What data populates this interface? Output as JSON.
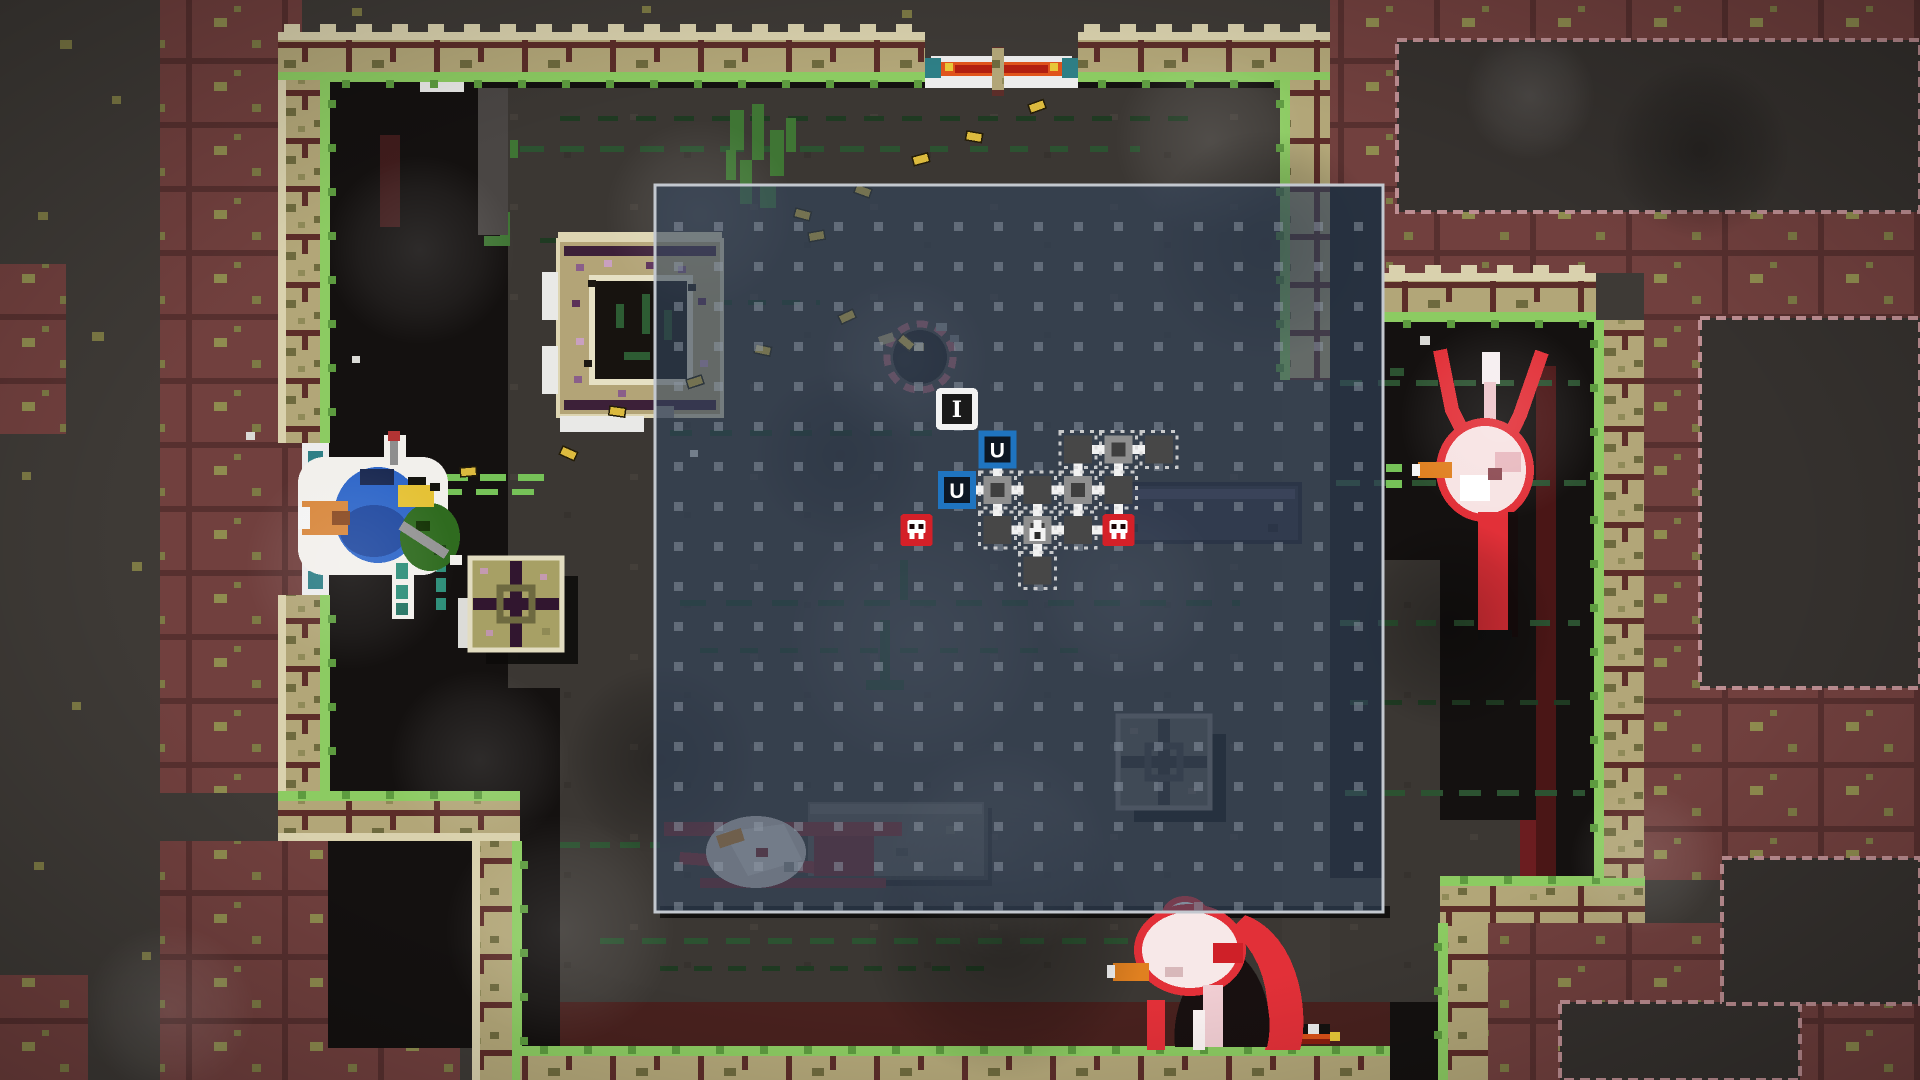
{
  "scene": {
    "description": "top-down pixel dungeon room with tactical map overlay",
    "width": 1920,
    "height": 1080
  },
  "letters": {
    "item_node": "I",
    "unknown_node": "U"
  },
  "colors": {
    "outer_grey": "#3e3a36",
    "maroon": "#71403e",
    "patch_fill": "#35312e",
    "patch_outline": "#bd8e92",
    "khaki": "#b2a678",
    "mortar": "#5c2d29",
    "cream": "#d9d1ad",
    "grass": "#8ccb62",
    "grass_dark": "#5d9b3f",
    "floor_black": "#141110",
    "floor_grey": "#3b3733",
    "overlay_fill": "#33455e",
    "overlay_border": "#c3c8cf",
    "grid_dot": "#8f99a6",
    "casing": "#dcba3e",
    "olive_speckle": "#7d7a45",
    "green_bright": "#76c258",
    "green_dark": "#2c5231",
    "green_darker": "#1f3a22",
    "teal": "#2e8f7a",
    "vine": "#3f7534",
    "node_dark": "#474747",
    "node_lit": "#8f8f8f",
    "node_inner": "#3f3f3f",
    "node_dotted": "#d9d9d9",
    "skull_red": "#d42028",
    "unknown_blue": "#1f74c0",
    "item_white": "#f2f2f2",
    "connector_white": "#f2f2f2"
  },
  "map": {
    "maroon_areas": [
      [
        160,
        0,
        142,
        793
      ],
      [
        0,
        264,
        66,
        170
      ],
      [
        1330,
        0,
        590,
        187
      ],
      [
        1383,
        187,
        537,
        86
      ],
      [
        1644,
        273,
        276,
        607
      ],
      [
        1482,
        923,
        438,
        157
      ],
      [
        160,
        841,
        300,
        239
      ],
      [
        0,
        975,
        88,
        105
      ]
    ],
    "pink_patches": [
      [
        1397,
        40,
        523,
        172
      ],
      [
        1700,
        318,
        220,
        370
      ],
      [
        1560,
        1002,
        240,
        78
      ],
      [
        1722,
        858,
        198,
        146
      ]
    ],
    "floors_black": [
      [
        328,
        80,
        954,
        968
      ],
      [
        1330,
        187,
        53,
        691
      ],
      [
        1383,
        320,
        213,
        558
      ],
      [
        1540,
        820,
        57,
        58
      ],
      [
        1390,
        1002,
        50,
        78
      ]
    ],
    "floors_grey": [
      [
        508,
        88,
        774,
        600
      ],
      [
        560,
        688,
        722,
        314
      ],
      [
        1383,
        560,
        57,
        442
      ],
      [
        1330,
        878,
        110,
        124
      ],
      [
        1430,
        820,
        90,
        58
      ]
    ],
    "red_bands": [
      [
        560,
        1002,
        830,
        46,
        "#48211e"
      ],
      [
        1520,
        820,
        20,
        58,
        "#6b1d20"
      ],
      [
        1536,
        366,
        20,
        512,
        "#4a1616"
      ],
      [
        380,
        135,
        20,
        92,
        "#3f1c1c"
      ]
    ],
    "dark_lines": [
      [
        660,
        906,
        730,
        12
      ]
    ],
    "walls": [
      {
        "x": 278,
        "y": 32,
        "w": 647,
        "h": 48,
        "cream": "top",
        "green": "bottom"
      },
      {
        "x": 1078,
        "y": 32,
        "w": 252,
        "h": 48,
        "cream": "top",
        "green": "bottom"
      },
      {
        "x": 278,
        "y": 80,
        "w": 50,
        "h": 363,
        "cream": "left",
        "green": "right"
      },
      {
        "x": 278,
        "y": 595,
        "w": 50,
        "h": 198,
        "cream": "left",
        "green": "right"
      },
      {
        "x": 278,
        "y": 793,
        "w": 242,
        "h": 48,
        "cream": "bottom",
        "green": "top"
      },
      {
        "x": 472,
        "y": 841,
        "w": 48,
        "h": 239,
        "cream": "left",
        "green": "right"
      },
      {
        "x": 520,
        "y": 1048,
        "w": 870,
        "h": 32,
        "green": "top"
      },
      {
        "x": 1440,
        "y": 923,
        "w": 48,
        "h": 157,
        "green": "left"
      },
      {
        "x": 1440,
        "y": 878,
        "w": 205,
        "h": 45,
        "green": "top"
      },
      {
        "x": 1596,
        "y": 320,
        "w": 48,
        "h": 558,
        "green": "left"
      },
      {
        "x": 1383,
        "y": 273,
        "w": 213,
        "h": 47,
        "cream": "top",
        "green": "bottom"
      },
      {
        "x": 1282,
        "y": 80,
        "w": 48,
        "h": 300,
        "green": "left"
      }
    ],
    "wall_pillar": [
      992,
      47,
      12,
      49
    ],
    "green_lines": [
      [
        404,
        474,
        142,
        7,
        "b",
        "26 12"
      ],
      [
        404,
        489,
        142,
        6,
        "b",
        "22 14"
      ],
      [
        520,
        146,
        380,
        6,
        "d",
        "24 16"
      ],
      [
        930,
        146,
        210,
        6,
        "d",
        "18 22"
      ],
      [
        560,
        116,
        640,
        5,
        "dd",
        "20 18"
      ],
      [
        540,
        238,
        180,
        5,
        "dd",
        "16 14"
      ],
      [
        680,
        300,
        140,
        5,
        "dd",
        "18 16"
      ],
      [
        670,
        430,
        270,
        6,
        "dd",
        "22 18"
      ],
      [
        680,
        600,
        560,
        6,
        "dd",
        "26 20"
      ],
      [
        700,
        648,
        400,
        5,
        "dd",
        "18 22"
      ],
      [
        600,
        938,
        660,
        6,
        "d",
        "24 18"
      ],
      [
        660,
        966,
        340,
        5,
        "dd",
        "18 16"
      ],
      [
        560,
        842,
        100,
        6,
        "d",
        "20 10"
      ],
      [
        1340,
        380,
        240,
        6,
        "d",
        "22 16"
      ],
      [
        1336,
        480,
        250,
        6,
        "d",
        "24 14"
      ],
      [
        1340,
        620,
        240,
        6,
        "d",
        "20 18"
      ],
      [
        1350,
        700,
        220,
        5,
        "dd",
        "18 16"
      ],
      [
        1345,
        790,
        240,
        6,
        "d",
        "22 16"
      ],
      [
        1386,
        464,
        16,
        8,
        "b",
        ""
      ],
      [
        1386,
        480,
        16,
        8,
        "b",
        ""
      ]
    ],
    "green_pixels": [
      [
        436,
        556,
        10,
        16,
        "t"
      ],
      [
        436,
        578,
        10,
        14,
        "t"
      ],
      [
        436,
        598,
        10,
        12,
        "t"
      ],
      [
        484,
        150,
        10,
        24,
        "v"
      ],
      [
        492,
        178,
        12,
        30,
        "v"
      ],
      [
        500,
        212,
        10,
        26,
        "v"
      ],
      [
        510,
        140,
        8,
        18,
        "v"
      ],
      [
        484,
        236,
        26,
        10,
        "v"
      ],
      [
        730,
        110,
        14,
        40,
        "v"
      ],
      [
        752,
        104,
        12,
        56,
        "v"
      ],
      [
        770,
        130,
        14,
        46,
        "v"
      ],
      [
        740,
        160,
        12,
        44,
        "v"
      ],
      [
        760,
        186,
        16,
        22,
        "v"
      ],
      [
        726,
        150,
        10,
        30,
        "v"
      ],
      [
        786,
        118,
        10,
        34,
        "v"
      ],
      [
        1390,
        368,
        14,
        8,
        "d"
      ],
      [
        880,
        620,
        10,
        60,
        "dd"
      ],
      [
        866,
        680,
        38,
        10,
        "dd"
      ],
      [
        900,
        560,
        8,
        40,
        "dd"
      ]
    ],
    "olive_speckles": [
      [
        60,
        40,
        12,
        9
      ],
      [
        112,
        96,
        9,
        8
      ],
      [
        38,
        212,
        10,
        8
      ],
      [
        92,
        332,
        12,
        9
      ],
      [
        22,
        472,
        9,
        8
      ],
      [
        132,
        562,
        10,
        9
      ],
      [
        72,
        702,
        9,
        8
      ],
      [
        34,
        862,
        10,
        8
      ],
      [
        142,
        952,
        9,
        8
      ],
      [
        184,
        1022,
        10,
        8
      ],
      [
        352,
        8,
        10,
        8
      ],
      [
        642,
        6,
        9,
        7
      ],
      [
        902,
        10,
        10,
        8
      ],
      [
        1352,
        14,
        9,
        8
      ],
      [
        1662,
        122,
        12,
        9
      ],
      [
        1852,
        62,
        10,
        8
      ],
      [
        1792,
        242,
        9,
        8
      ],
      [
        1882,
        332,
        10,
        9
      ],
      [
        1702,
        562,
        10,
        8
      ],
      [
        1862,
        642,
        9,
        8
      ],
      [
        1742,
        762,
        10,
        9
      ],
      [
        1892,
        822,
        9,
        8
      ],
      [
        240,
        1062,
        10,
        8
      ],
      [
        520,
        1066,
        9,
        7
      ]
    ],
    "hang_strip": {
      "strip": [
        478,
        88,
        30,
        147
      ],
      "white_bar": [
        420,
        80,
        44,
        12
      ]
    }
  },
  "doors": [
    {
      "name": "doorway-top",
      "sprite": "spr-door-h",
      "x": 925,
      "y": 56
    },
    {
      "name": "doorway-left",
      "sprite": "spr-door-v",
      "x": 302,
      "y": 443
    },
    {
      "name": "doorway-bottom",
      "sprite": "spr-door-checker",
      "x": 1198,
      "y": 1024
    }
  ],
  "entities": [
    {
      "name": "ammo-table-ring",
      "sprite": "spr-tablering",
      "x": 558,
      "y": 240,
      "i": false
    },
    {
      "name": "supply-crate",
      "sprite": "spr-crate",
      "x": 470,
      "y": 558,
      "i": true
    },
    {
      "name": "dark-crate",
      "sprite": "spr-crate-dark",
      "x": 1118,
      "y": 716,
      "i": true
    },
    {
      "name": "long-table-dark",
      "sprite": "spr-tabledark",
      "x": 1108,
      "y": 484,
      "i": false
    },
    {
      "name": "long-table-grey",
      "sprite": "spr-tablegrey",
      "x": 806,
      "y": 800,
      "i": false
    },
    {
      "name": "dead-bird-corpse",
      "sprite": "spr-deadbird",
      "x": 664,
      "y": 802,
      "i": false
    },
    {
      "name": "floor-pit",
      "sprite": "spr-pit",
      "x": 920,
      "y": 357,
      "i": false
    },
    {
      "name": "player-character",
      "sprite": "spr-player",
      "x": 390,
      "y": 515,
      "i": true
    },
    {
      "name": "enemy-bird-right",
      "sprite": "spr-bird",
      "x": 1490,
      "y": 470,
      "i": true
    },
    {
      "name": "enemy-bird-bottom",
      "sprite": "spr-bird2",
      "x": 1205,
      "y": 975,
      "i": true
    }
  ],
  "casings": [
    [
      838,
      316,
      -25
    ],
    [
      756,
      344,
      12
    ],
    [
      610,
      406,
      8
    ],
    [
      686,
      380,
      -18
    ],
    [
      563,
      446,
      24
    ],
    [
      460,
      468,
      -5
    ],
    [
      903,
      334,
      40
    ],
    [
      796,
      208,
      15
    ],
    [
      857,
      184,
      20
    ],
    [
      912,
      157,
      -15
    ],
    [
      967,
      131,
      10
    ],
    [
      1028,
      105,
      -20
    ],
    [
      808,
      233,
      -10
    ]
  ],
  "debris": [
    [
      1420,
      336,
      10
    ],
    [
      246,
      432,
      9
    ],
    [
      352,
      356,
      8
    ],
    [
      690,
      450,
      8
    ]
  ],
  "glows": [
    [
      420,
      250,
      95
    ],
    [
      350,
      565,
      105
    ],
    [
      560,
      930,
      115
    ],
    [
      700,
      215,
      95
    ],
    [
      915,
      640,
      130
    ],
    [
      1000,
      850,
      110
    ],
    [
      1210,
      140,
      95
    ],
    [
      1530,
      95,
      65
    ],
    [
      1645,
      860,
      75
    ],
    [
      170,
      1010,
      85
    ],
    [
      905,
      360,
      85
    ],
    [
      1125,
      590,
      95
    ],
    [
      480,
      760,
      90
    ],
    [
      1500,
      420,
      100
    ]
  ],
  "shadows": [
    [
      1005,
      940,
      140
    ],
    [
      1450,
      625,
      105
    ],
    [
      840,
      455,
      85
    ],
    [
      1265,
      245,
      115
    ],
    [
      1700,
      150,
      90
    ],
    [
      660,
      760,
      95
    ]
  ],
  "overlay": {
    "x": 655,
    "y": 185,
    "w": 728,
    "h": 727,
    "fill_opacity": 0.62,
    "grid": {
      "offset_x": 19,
      "offset_y": 37,
      "pitch": 40,
      "size": 9,
      "opacity": 0.5
    },
    "graph": {
      "origin_x": 916.5,
      "origin_y": 409,
      "pitch": 40.4,
      "nodes": [
        {
          "c": 1,
          "r": 0,
          "t": "item"
        },
        {
          "c": 2,
          "r": 1,
          "t": "unknown"
        },
        {
          "c": 4,
          "r": 1,
          "t": "room-dark"
        },
        {
          "c": 5,
          "r": 1,
          "t": "room-lit"
        },
        {
          "c": 6,
          "r": 1,
          "t": "room-dark"
        },
        {
          "c": 1,
          "r": 2,
          "t": "unknown"
        },
        {
          "c": 2,
          "r": 2,
          "t": "room-lit"
        },
        {
          "c": 3,
          "r": 2,
          "t": "room-dark"
        },
        {
          "c": 4,
          "r": 2,
          "t": "room-lit"
        },
        {
          "c": 5,
          "r": 2,
          "t": "room-dark"
        },
        {
          "c": 0,
          "r": 3,
          "t": "skull"
        },
        {
          "c": 2,
          "r": 3,
          "t": "room-dark"
        },
        {
          "c": 3,
          "r": 3,
          "t": "altar"
        },
        {
          "c": 4,
          "r": 3,
          "t": "room-dark"
        },
        {
          "c": 5,
          "r": 3,
          "t": "skull"
        },
        {
          "c": 3,
          "r": 4,
          "t": "room-dark"
        }
      ],
      "connectors": [
        [
          2,
          1,
          2,
          2
        ],
        [
          1,
          2,
          2,
          2
        ],
        [
          2,
          2,
          3,
          2
        ],
        [
          3,
          2,
          4,
          2
        ],
        [
          4,
          2,
          5,
          2
        ],
        [
          4,
          1,
          5,
          1
        ],
        [
          5,
          1,
          6,
          1
        ],
        [
          4,
          1,
          4,
          2
        ],
        [
          5,
          1,
          5,
          2
        ],
        [
          2,
          2,
          2,
          3
        ],
        [
          3,
          2,
          3,
          3
        ],
        [
          4,
          2,
          4,
          3
        ],
        [
          5,
          2,
          5,
          3
        ],
        [
          2,
          3,
          3,
          3
        ],
        [
          3,
          3,
          4,
          3
        ],
        [
          4,
          3,
          5,
          3
        ],
        [
          3,
          3,
          3,
          4
        ]
      ]
    }
  }
}
